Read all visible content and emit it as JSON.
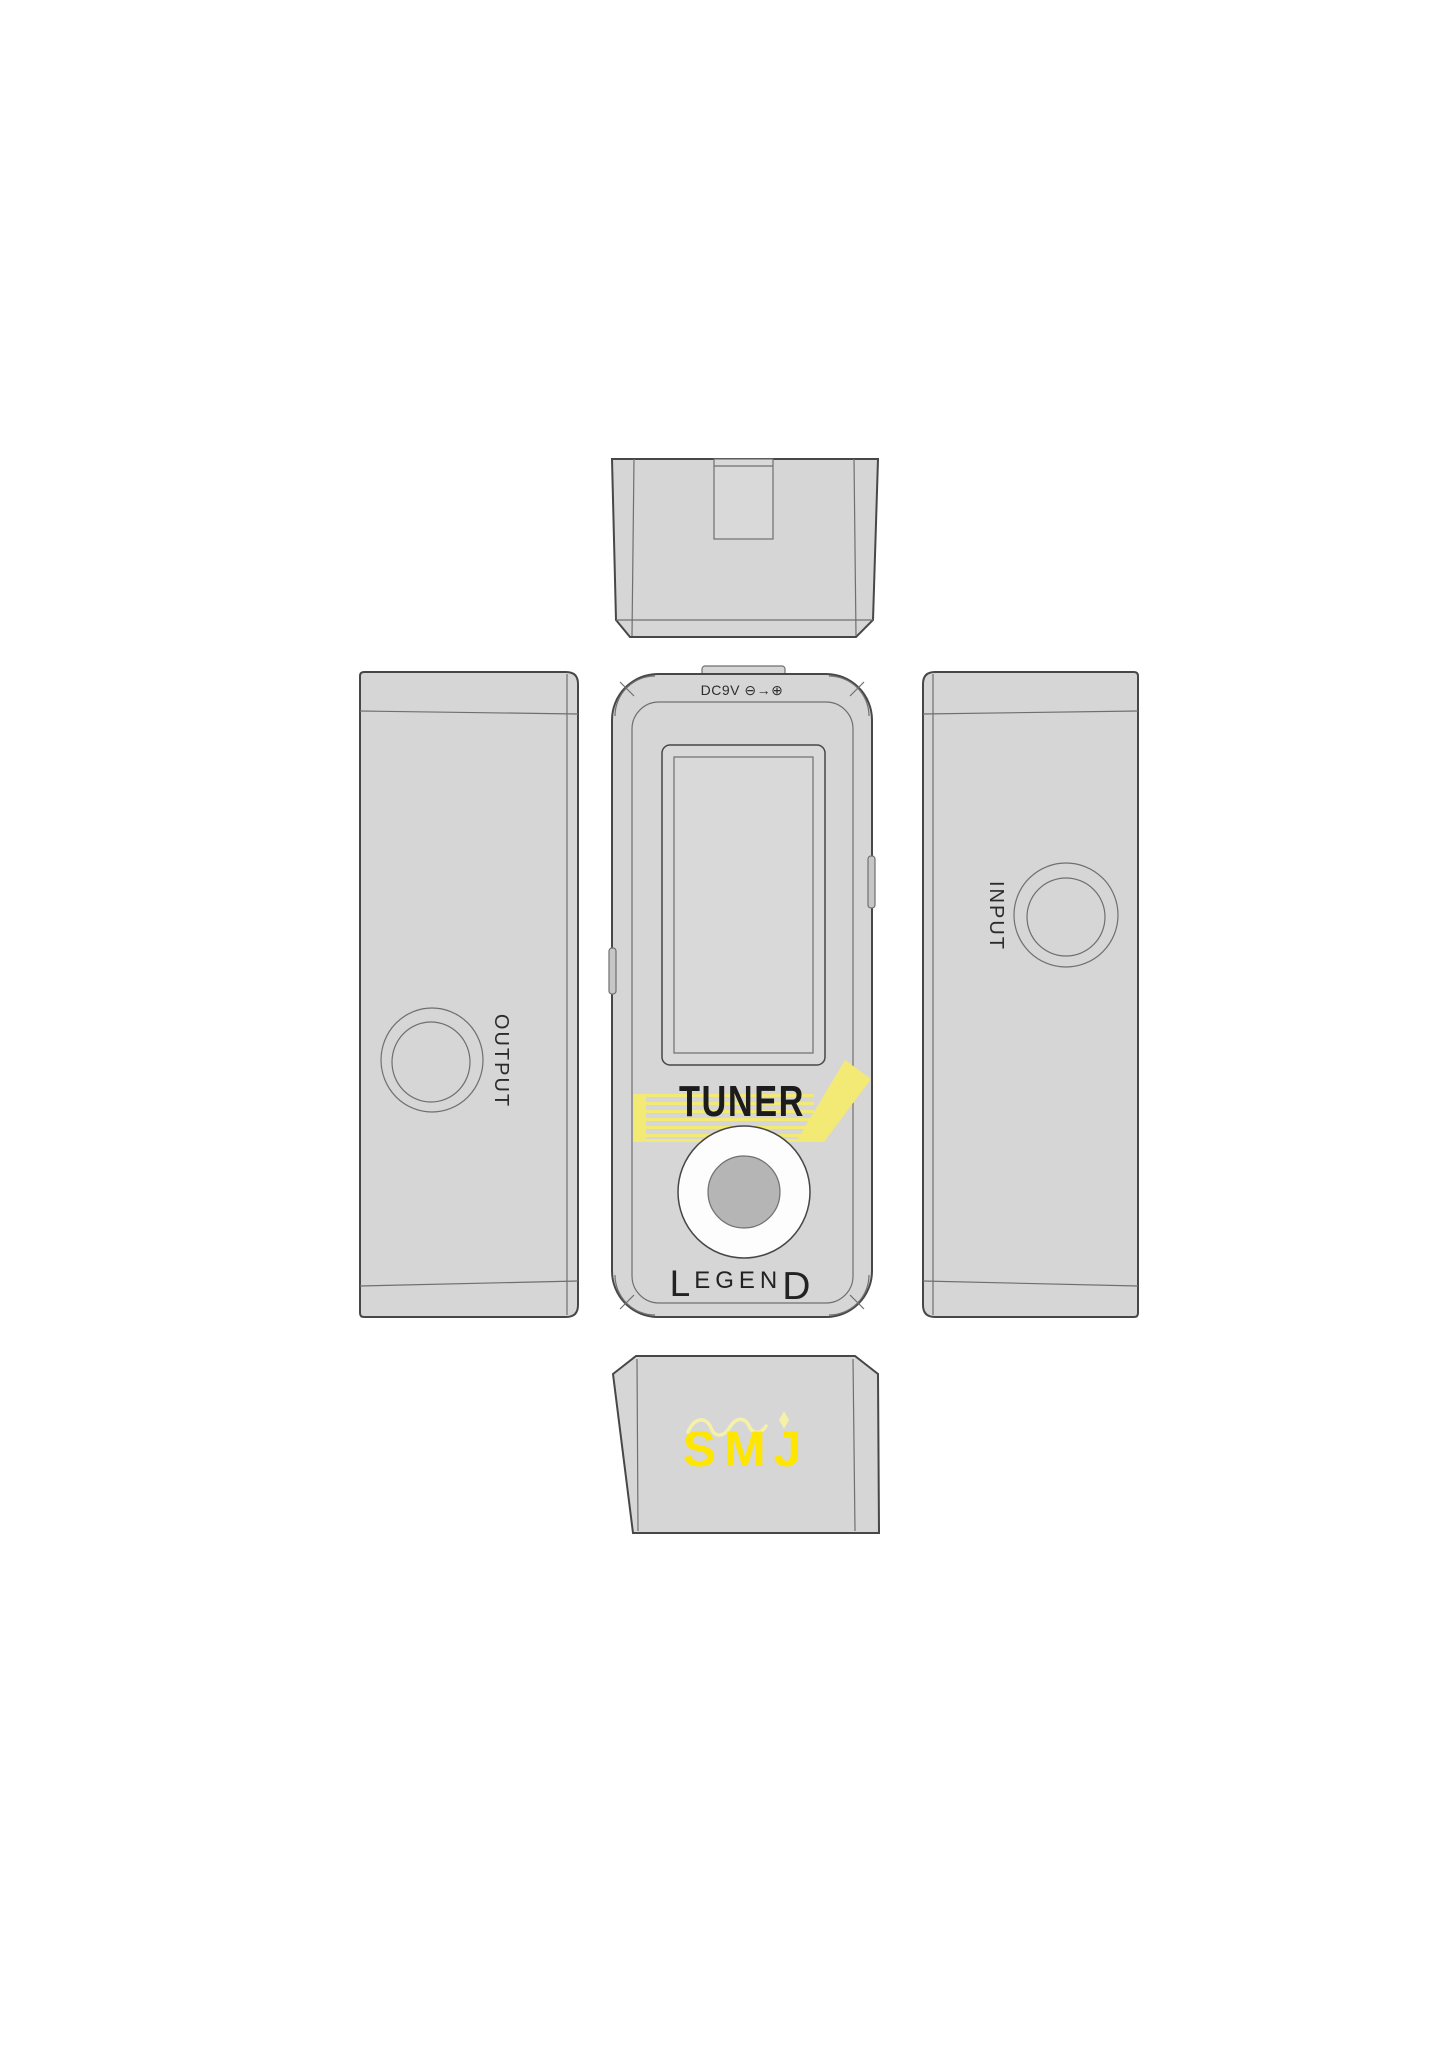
{
  "diagram": {
    "front_view": {
      "power_label": "DC9V ⊖→⊕",
      "model_name": "TUNER",
      "brand": {
        "first": "L",
        "middle": "EGEN",
        "last": "D"
      }
    },
    "left_side_view": {
      "jack_label": "OUTPUT"
    },
    "right_side_view": {
      "jack_label": "INPUT"
    },
    "bottom_view": {
      "logo": "SMJ"
    }
  },
  "colors": {
    "body_gray": "#d6d6d6",
    "body_gray2": "#d9d9d9",
    "line_dark": "#474747",
    "line_mid": "#6f6f6f",
    "accent_yellow": "#f2ea75",
    "logo_yellow": "#ffe600",
    "flourish_yellow": "#f6f1a8",
    "switch_white": "#fdfdfd",
    "switch_gray": "#b5b5b5",
    "label_black": "#1f1f1f"
  }
}
